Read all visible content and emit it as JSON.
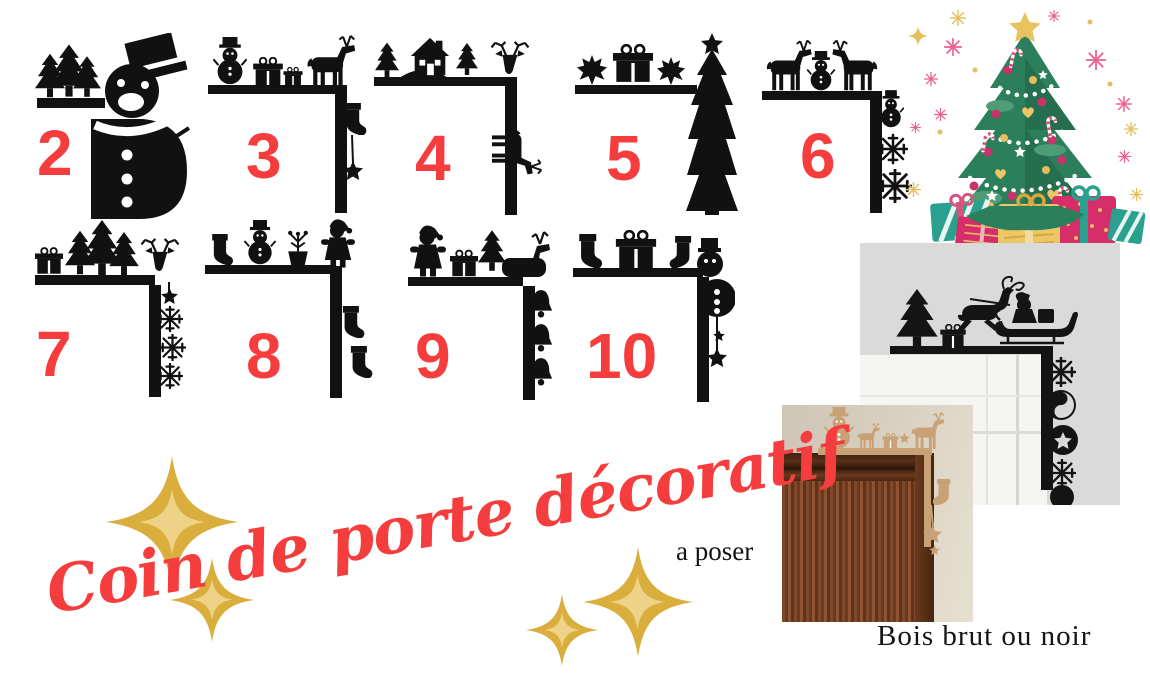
{
  "title": {
    "text": "Coin de porte décoratif",
    "color": "#f63d3d"
  },
  "captions": {
    "mount_type": "a poser",
    "material": "Bois brut ou noir"
  },
  "designs": [
    {
      "number": "2",
      "icon": "snowman-and-forest-corner"
    },
    {
      "number": "3",
      "icon": "snowman-gifts-deer-corner"
    },
    {
      "number": "4",
      "icon": "house-trees-stag-corner"
    },
    {
      "number": "5",
      "icon": "leaves-gift-christmas-tree-corner"
    },
    {
      "number": "6",
      "icon": "deer-pair-snowman-snowflakes-corner"
    },
    {
      "number": "7",
      "icon": "gift-trees-stag-snowflakes-corner"
    },
    {
      "number": "8",
      "icon": "stocking-snowman-plant-santa-corner"
    },
    {
      "number": "9",
      "icon": "santa-gift-tree-deer-bells-corner"
    },
    {
      "number": "10",
      "icon": "stockings-gift-snowman-star-corner"
    }
  ],
  "illustrations": {
    "christmas_tree": "decorated-christmas-tree-with-gifts",
    "photo_black": "black-sleigh-corner-decor-on-white-door-frame",
    "photo_wood": "raw-wood-corner-decor-on-brown-door"
  },
  "colors": {
    "accent_red": "#f63d3d",
    "silhouette_black": "#111111",
    "gold": "#d9ae3c",
    "wood": "#c8a276",
    "tree_green": "#2c7f5b",
    "magenta": "#d62e68",
    "teal": "#2aa08e"
  }
}
